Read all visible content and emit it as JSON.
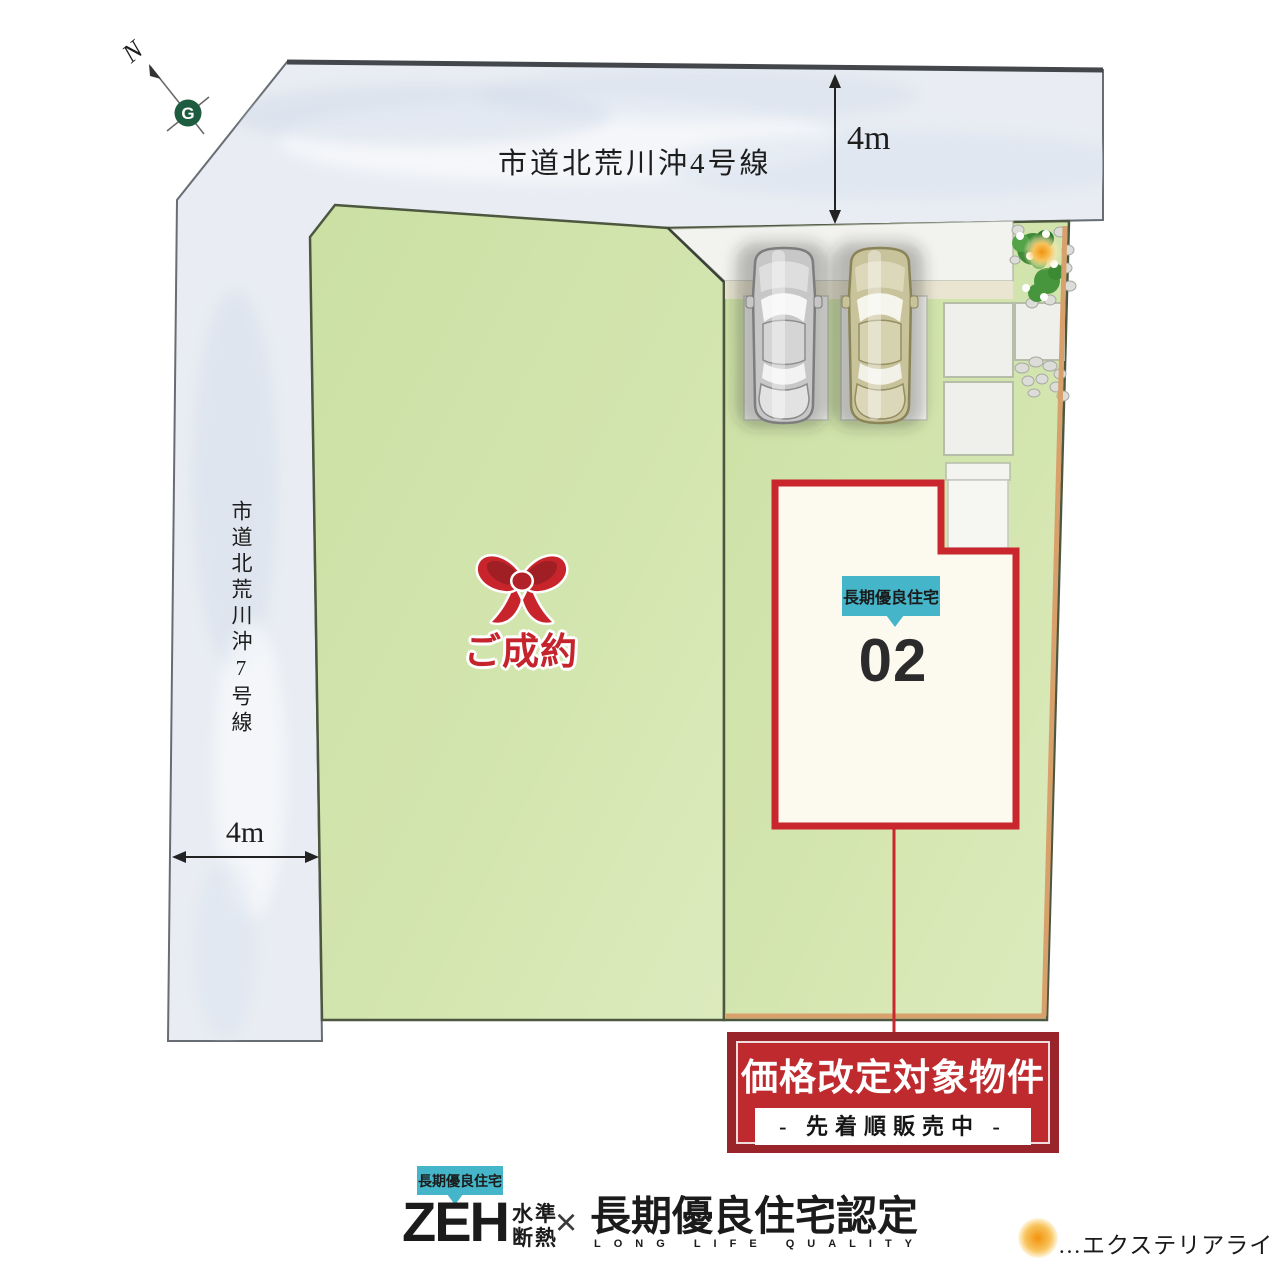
{
  "compass": {
    "north_label": "N",
    "logo_letter": "G"
  },
  "roads": {
    "top": {
      "name": "市道北荒川沖4号線",
      "width_label": "4m"
    },
    "left": {
      "name": "市道北荒川沖7号線",
      "width_label": "4m"
    }
  },
  "lots": {
    "lot1": {
      "status": "ご成約"
    },
    "lot2": {
      "number": "02",
      "badge": "長期優良住宅"
    }
  },
  "banner": {
    "title": "価格改定対象物件",
    "subtitle": "- 先着順販売中 -"
  },
  "footer": {
    "badge": "長期優良住宅",
    "zeh": "ZEH",
    "zeh_sub_top": "水準",
    "zeh_sub_bottom": "断熱",
    "multiply": "×",
    "cert": "長期優良住宅認定",
    "cert_sub": "LONG LIFE QUALITY"
  },
  "legend": {
    "text": "…エクステリアライト"
  },
  "colors": {
    "banner_red": "#bf2a2f",
    "banner_dark_red": "#992429",
    "outline_red": "#c9262d",
    "badge_teal": "#45b6c9",
    "lot_green": "#cfe3a8",
    "road_gray": "#e9edf3",
    "sold_red": "#c5242c",
    "fence_tan": "#d8a06b",
    "light_orange": "#f2930d"
  }
}
